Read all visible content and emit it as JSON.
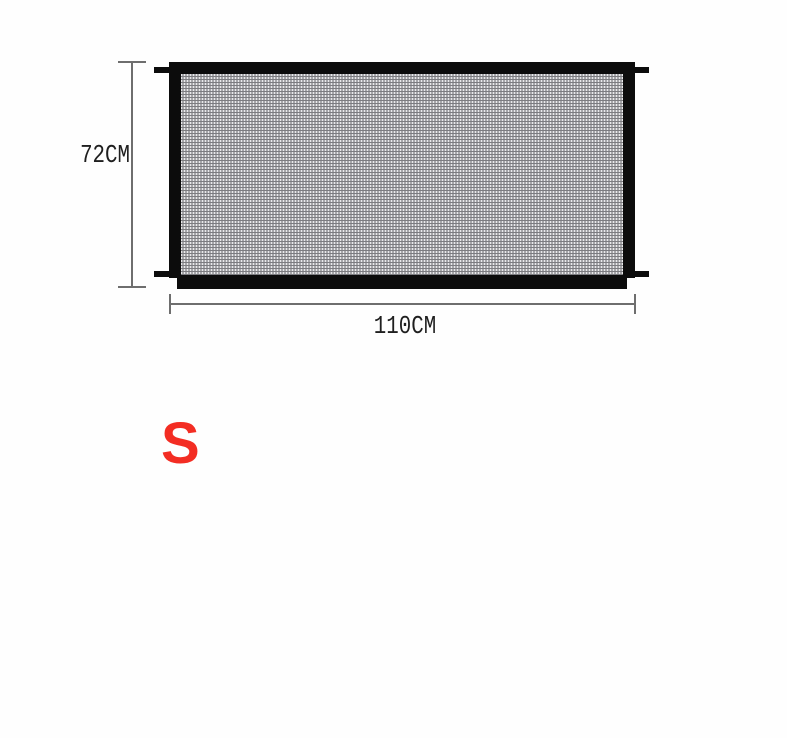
{
  "page": {
    "background": "#fefefe"
  },
  "diagram": {
    "height_label": "72CM",
    "width_label": "110CM",
    "size_label": "S",
    "colors": {
      "gate_frame": "#0c0c0c",
      "mesh_base": "#a7a7aa",
      "mesh_highlight": "#e9e9eb",
      "mesh_shadow": "#7c7c80",
      "dimension_line": "#6e6e6e",
      "label_text": "#1f1f1f",
      "size_label_red": "#f32d23"
    }
  }
}
